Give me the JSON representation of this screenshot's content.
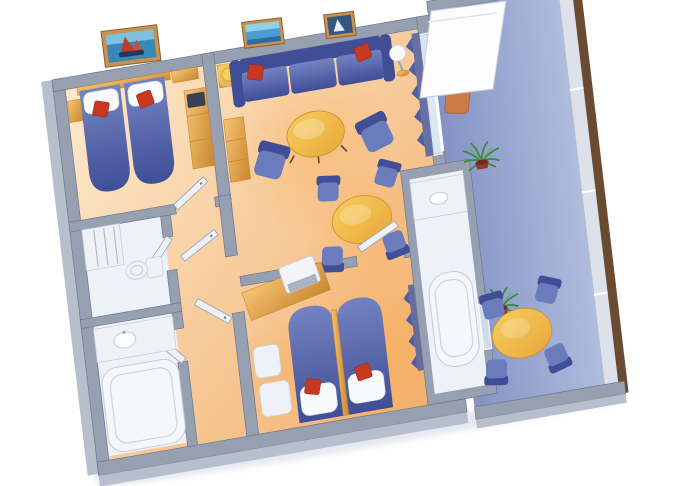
{
  "scene": {
    "type": "isometric-cutaway-floor-plan",
    "subject": "two-bedroom-suite-with-private-balcony",
    "background": "#ffffff",
    "rooms": [
      {
        "id": "bedroom-1",
        "furniture": [
          "twin-bed",
          "twin-bed",
          "headboard-shelf",
          "nightstand",
          "wood-bench",
          "tv-cabinet",
          "wall-picture-sailboat"
        ]
      },
      {
        "id": "living-room",
        "furniture": [
          "sofa",
          "red-throw-pillow",
          "red-throw-pillow",
          "side-table-with-lamp",
          "sphere-floor-lamp",
          "round-coffee-table",
          "armchair",
          "armchair",
          "wall-picture-seascape",
          "wall-picture-ship",
          "side-cabinet"
        ]
      },
      {
        "id": "dining-nook",
        "furniture": [
          "round-dining-table",
          "dining-chair",
          "dining-chair",
          "dining-chair",
          "dining-chair"
        ]
      },
      {
        "id": "hallway",
        "furniture": [
          "entry-door",
          "inner-door",
          "bedroom-door"
        ]
      },
      {
        "id": "bathroom-shower",
        "furniture": [
          "shower-stall",
          "toilet"
        ]
      },
      {
        "id": "bathroom-tub",
        "furniture": [
          "vanity-sink",
          "bathtub"
        ]
      },
      {
        "id": "bedroom-2",
        "furniture": [
          "bed",
          "bed",
          "desk",
          "tv-set",
          "bench-seat",
          "bench-seat",
          "red-throw-pillow",
          "red-throw-pillow",
          "curtains"
        ]
      },
      {
        "id": "ensuite-bathroom",
        "furniture": [
          "vanity-counter",
          "sink",
          "bathtub",
          "glass-door"
        ]
      },
      {
        "id": "balcony",
        "furniture": [
          "open-glass-door",
          "lounge-chair",
          "potted-palm",
          "potted-palm",
          "round-balcony-table",
          "balcony-chair",
          "balcony-chair",
          "balcony-chair",
          "balcony-chair",
          "railing-with-wood-cap"
        ]
      }
    ]
  },
  "colors": {
    "floor_light": "#fde9cd",
    "floor_dark": "#f2ae6a",
    "glow": "#f9a84e",
    "bath_floor": "#edf1f8",
    "balcony_light": "#b0bcdd",
    "balcony_dark": "#8493c6",
    "wall_top": "#96a0b0",
    "wall_edge": "#6e7890",
    "wall_face": "#b7bfcc",
    "fabric_light": "#7383c0",
    "fabric_mid": "#6b7cbd",
    "fabric_deep": "#3f4e97",
    "pillow": "#f8fafc",
    "cushion_red": "#c8371f",
    "wood_light": "#f6c475",
    "wood_dark": "#c9872f",
    "gold_light": "#f8cd5d",
    "gold_dark": "#e7a83a",
    "glass": "#d7e4f0",
    "curtain": "#4d5fa6",
    "rail_panel": "#dde1e9",
    "rail_cap": "#6b4a32",
    "plant_green": "#3c8a3c",
    "plant_pot": "#8d3a28",
    "tub_white": "#f4f7fb",
    "door_white": "#eef1f7",
    "frame_wood": "#c9924e",
    "terracotta": "#cd7a45",
    "shadow": "#cfd7e4"
  }
}
